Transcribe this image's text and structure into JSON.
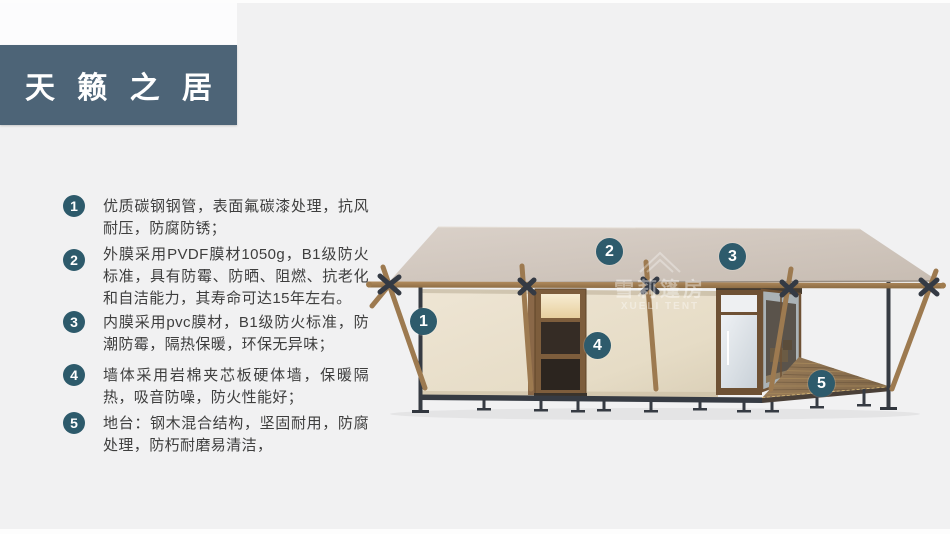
{
  "banner": {
    "title": "天 籁 之 居",
    "bg_color": "#4d6477",
    "text_color": "#ffffff"
  },
  "features": [
    {
      "num": "1",
      "text": "优质碳钢钢管，表面氟碳漆处理，抗风耐压，防腐防锈；"
    },
    {
      "num": "2",
      "text": "外膜采用PVDF膜材1050g，B1级防火标准，具有防霉、防晒、阻燃、抗老化和自洁能力，其寿命可达15年左右。"
    },
    {
      "num": "3",
      "text": "内膜采用pvc膜材，B1级防火标准，防潮防霉，隔热保暖，环保无异味；"
    },
    {
      "num": "4",
      "text": "墙体采用岩棉夹芯板硬体墙，保暖隔热，吸音防噪，防火性能好；"
    },
    {
      "num": "5",
      "text": "地台：钢木混合结构，坚固耐用，防腐处理，防朽耐磨易清洁，"
    }
  ],
  "callouts": [
    {
      "num": "1"
    },
    {
      "num": "2"
    },
    {
      "num": "3"
    },
    {
      "num": "4"
    },
    {
      "num": "5"
    }
  ],
  "watermark": {
    "cn": "雪莉篷房",
    "en": "XUELI TENT"
  },
  "colors": {
    "badge": "#2d5a6b",
    "callout": "#2e5b6c",
    "background": "#f1f1f2",
    "roof": "#d0c6bd",
    "wall": "#e8dfcc",
    "wood": "#9d7a50",
    "steel": "#363b43"
  }
}
